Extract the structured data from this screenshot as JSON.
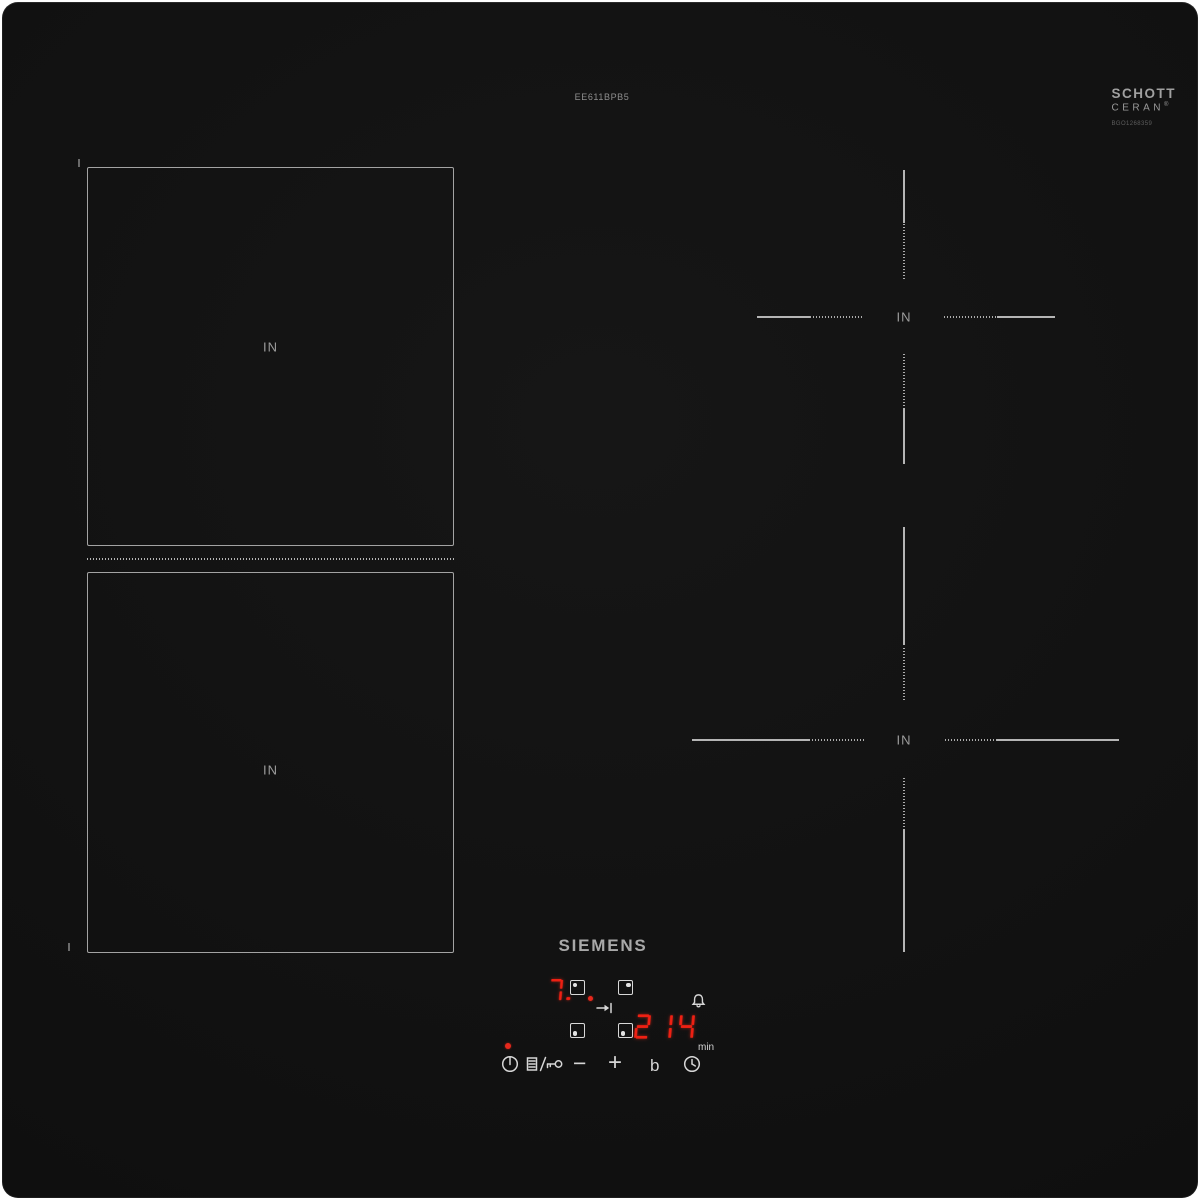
{
  "product": {
    "brand": "SIEMENS",
    "model": "EE611BPB5"
  },
  "glass": {
    "maker_line1": "SCHOTT",
    "maker_line2": "CERAN",
    "registered_mark": "®",
    "print_code": "BGO1268359"
  },
  "zones": {
    "left_top": "IN",
    "left_bottom": "IN",
    "right_top": "IN",
    "right_bottom": "IN"
  },
  "controls": {
    "power_level_display": "7.",
    "timer_display": "214",
    "timer_unit": "min",
    "minus_label": "−",
    "plus_label": "+",
    "boost_label": "b"
  },
  "icons": {
    "power": "power-icon",
    "wipe_lock": "wipe-protection-key-icon",
    "bridge": "bridge-arrow-icon",
    "bridge_glyph": "⇥",
    "bell": "alarm-bell-icon",
    "clock": "timer-clock-icon",
    "zone_select": "zone-select-square-icon"
  },
  "colors": {
    "surface_black": "#0e0e0e",
    "led_red": "#ee2013",
    "line_gray": "#a8a8a8",
    "label_gray": "#9c9c9c",
    "control_white": "#d6d6d6"
  }
}
